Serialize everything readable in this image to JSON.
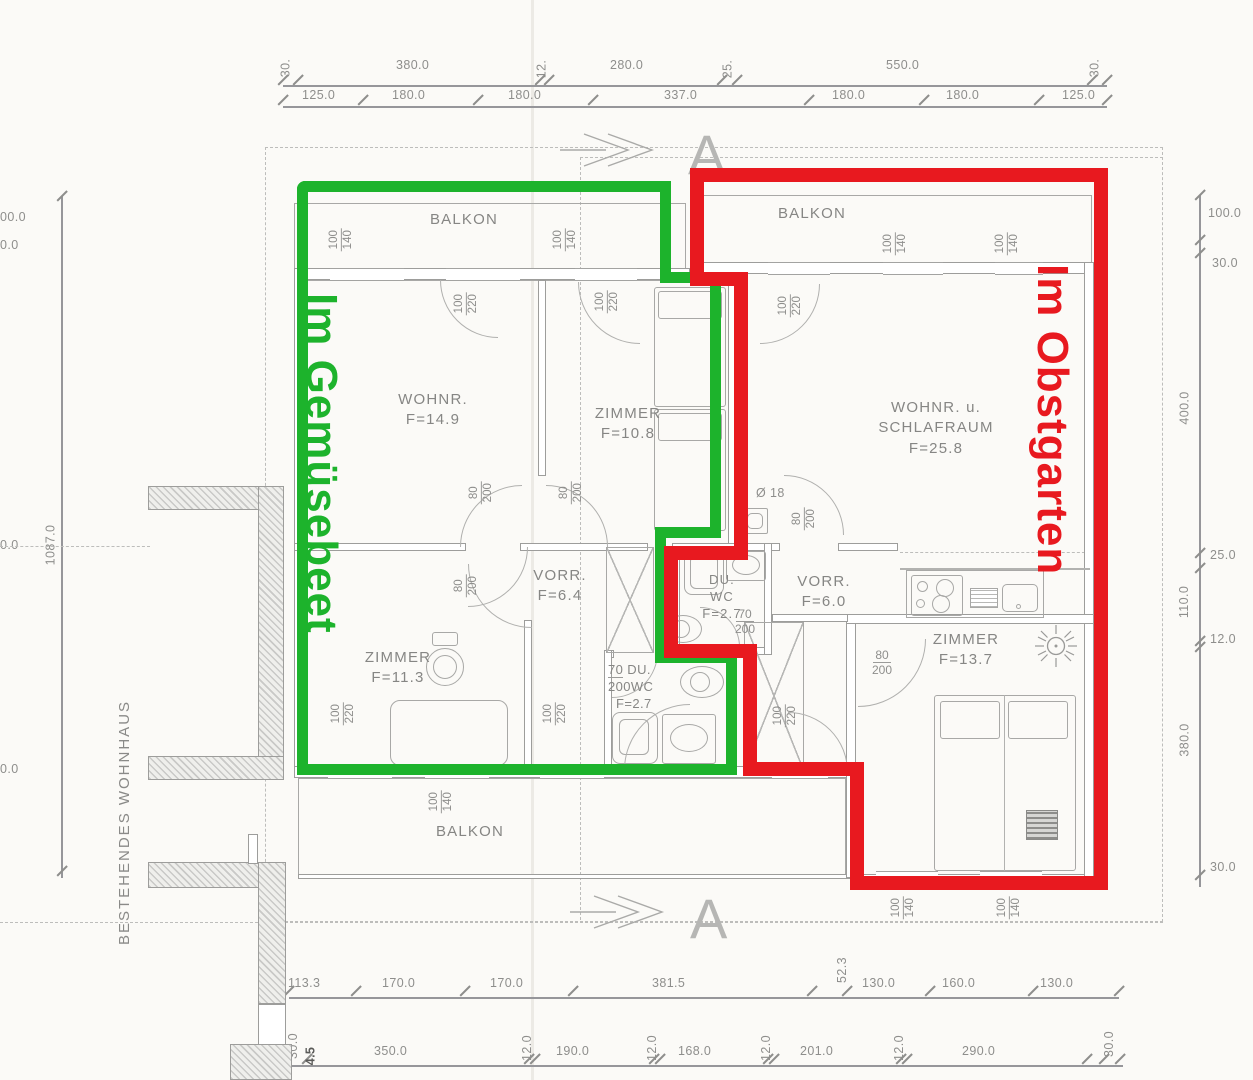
{
  "plan": {
    "unit_green_name": "Im Gemüsebeet",
    "unit_red_name": "Im Obstgarten",
    "existing_building_note": "BESTEHENDES WOHNHAUS",
    "section_letter": "A",
    "diameter_note": "Ø 18"
  },
  "colors": {
    "green": "#1db32c",
    "red": "#e8191f",
    "line_gray": "#9d9d9b",
    "text_gray": "#8e8e8c"
  },
  "rooms": {
    "wohnr": {
      "name": "WOHNR.",
      "area": "F=14.9"
    },
    "zimmer_top": {
      "name": "ZIMMER",
      "area": "F=10.8"
    },
    "schlafraum": {
      "name1": "WOHNR. u.",
      "name2": "SCHLAFRAUM",
      "area": "F=25.8"
    },
    "vorraum1": {
      "name": "VORR.",
      "area": "F=6.4"
    },
    "duwc1": {
      "name1": "DU.",
      "name2": "WC",
      "area": "F=2.7"
    },
    "vorraum2": {
      "name": "VORR.",
      "area": "F=6.0"
    },
    "zimmer_left": {
      "name": "ZIMMER",
      "area": "F=11.3"
    },
    "duwc2": {
      "name1": "DU.",
      "name2": "WC",
      "area": "F=2.7"
    },
    "zimmer_right": {
      "name": "ZIMMER",
      "area": "F=13.7"
    },
    "balkon": "BALKON"
  },
  "sizes": {
    "s70": "70",
    "s80": "80",
    "s100": "100",
    "s140": "140",
    "s200": "200",
    "s220": "220"
  },
  "dims": {
    "top1": [
      "30.",
      "380.0",
      "12.",
      "280.0",
      "25.",
      "550.0",
      "30."
    ],
    "top2": [
      "125.0",
      "180.0",
      "180.0",
      "337.0",
      "180.0",
      "180.0",
      "125.0"
    ],
    "right": [
      "100.0",
      "30.0",
      "400.0",
      "25.0",
      "110.0",
      "12.0",
      "380.0",
      "30.0"
    ],
    "left": {
      "total": "1087.0",
      "edge": [
        "00.0",
        "0.0",
        "0.0",
        "0.0"
      ]
    },
    "bottom1": [
      "113.3",
      "170.0",
      "170.0",
      "381.5",
      "52.3",
      "130.0",
      "160.0",
      "130.0"
    ],
    "bottom2": [
      "30.0",
      "4.5",
      "350.0",
      "12.0",
      "190.0",
      "12.0",
      "168.0",
      "12.0",
      "201.0",
      "12.0",
      "290.0",
      "30.0"
    ]
  }
}
